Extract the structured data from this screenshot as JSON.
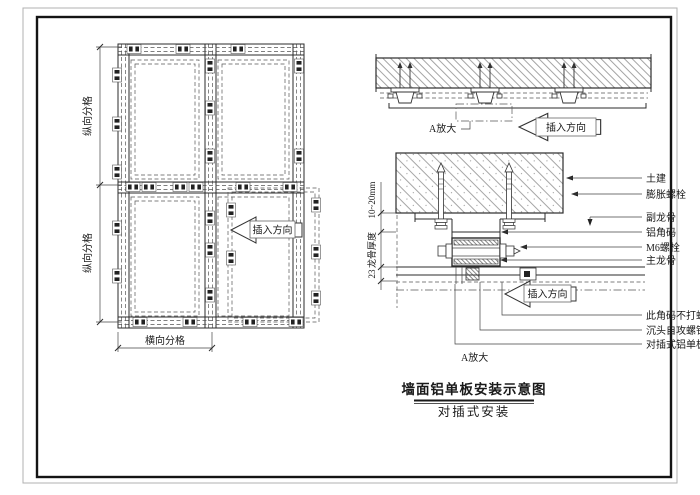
{
  "elevation": {
    "vertical_grid_label_top": "纵向分格",
    "vertical_grid_label_bottom": "纵向分格",
    "horizontal_grid_label": "横向分格",
    "insert_direction": "插入方向"
  },
  "plan_section": {
    "detail_callout": "A放大",
    "insert_direction": "插入方向"
  },
  "detail_section": {
    "dim_gap": "10~20mm",
    "dim_keel_thickness": "龙骨厚度",
    "dim_panel": "23",
    "label_civil": "土建",
    "label_expansion_bolt": "膨胀螺栓",
    "label_secondary_keel": "副龙骨",
    "label_alu_bracket": "铝角码",
    "label_m6_bolt": "M6螺栓",
    "label_main_keel": "主龙骨",
    "label_bracket_no_screw": "此角码不打螺钉",
    "label_countersunk_screw": "沉头自攻螺钉固定",
    "label_plug_panel": "对插式铝单板",
    "detail_callout": "A放大",
    "insert_direction": "插入方向"
  },
  "title_block": {
    "title": "墙面铝单板安装示意图",
    "subtitle": "对插式安装"
  }
}
